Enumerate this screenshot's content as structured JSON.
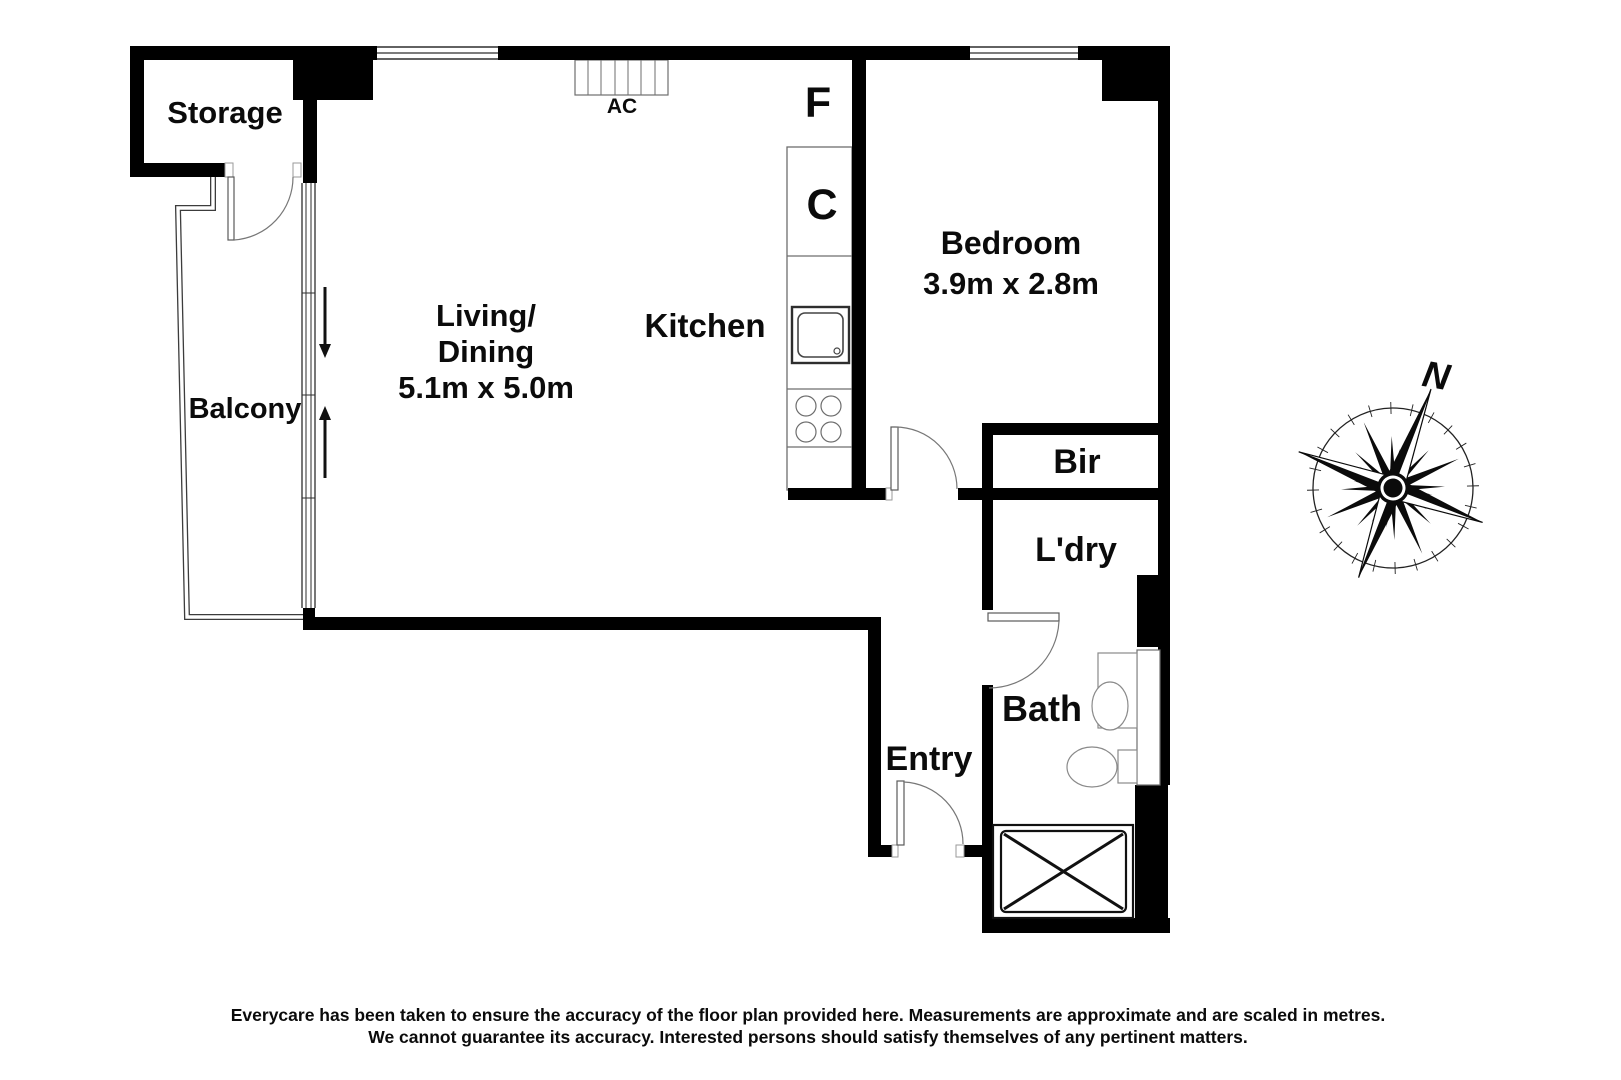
{
  "floorplan": {
    "rooms": {
      "storage": "Storage",
      "balcony": "Balcony",
      "living_line1": "Living/",
      "living_line2": "Dining",
      "living_dims": "5.1m x 5.0m",
      "kitchen": "Kitchen",
      "bedroom": "Bedroom",
      "bedroom_dims": "3.9m x 2.8m",
      "robe": "Bir",
      "laundry": "L'dry",
      "bath": "Bath",
      "entry": "Entry"
    },
    "fixtures": {
      "air_conditioner": "AC",
      "fridge": "F",
      "cupboard": "C"
    },
    "compass": {
      "north": "N"
    },
    "colors": {
      "wall": "#000000",
      "background": "#ffffff",
      "fixture_line": "#6e6e6e",
      "outline": "#3c3c3c"
    }
  },
  "disclaimer": {
    "line1": "Everycare has been taken to ensure the accuracy of the floor plan provided here. Measurements are approximate and are scaled in metres.",
    "line2": "We cannot guarantee its accuracy. Interested persons should satisfy themselves of any pertinent matters."
  }
}
